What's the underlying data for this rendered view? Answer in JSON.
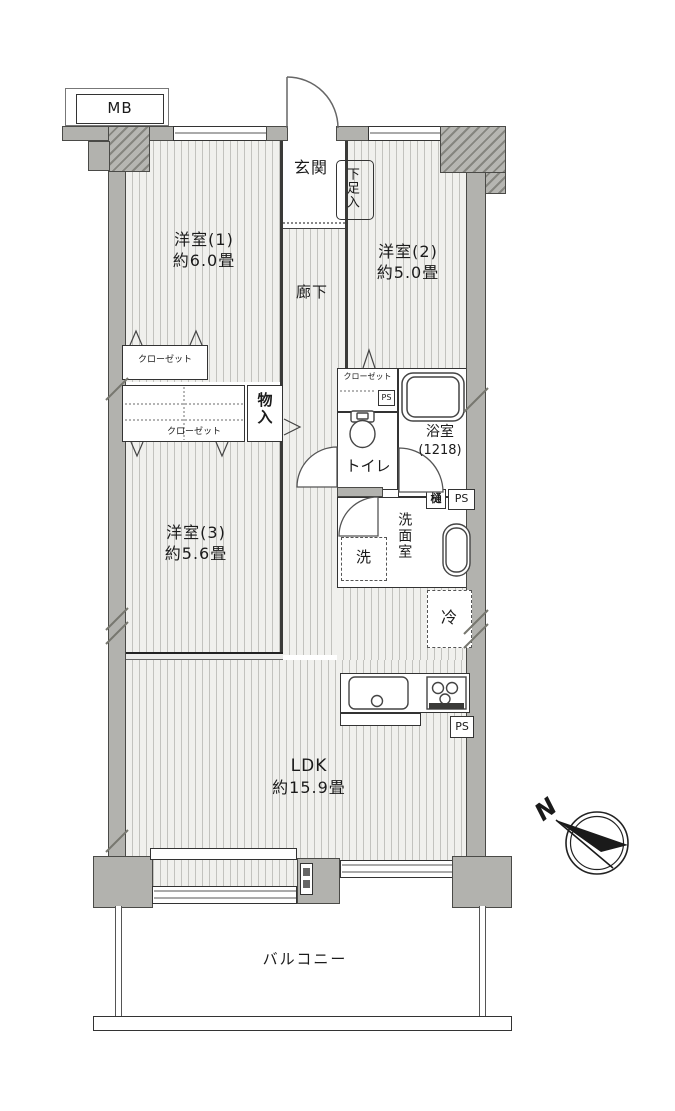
{
  "labels": {
    "mb": "MB",
    "genkan": "玄関",
    "shoebox": "下足入",
    "hallway": "廊下",
    "room1_name": "洋室(1)",
    "room1_size": "約6.0畳",
    "room2_name": "洋室(2)",
    "room2_size": "約5.0畳",
    "room3_name": "洋室(3)",
    "room3_size": "約5.6畳",
    "closet1": "クローゼット",
    "closet2": "クローゼット",
    "closet3": "クローゼット",
    "storage": "物入",
    "toilet": "トイレ",
    "bath_name": "浴室",
    "bath_size": "(1218)",
    "gutter": "樋",
    "ps1": "PS",
    "ps2": "PS",
    "ps3": "PS",
    "washroom": "洗面室",
    "washer": "洗",
    "fridge": "冷",
    "ldk_name": "LDK",
    "ldk_size": "約15.9畳",
    "balcony": "バルコニー",
    "north": "N"
  },
  "colors": {
    "wall": "#b2b2ae",
    "line": "#333333",
    "floor_bg": "#f0f0ed",
    "floor_stripe": "#c2c2be"
  }
}
